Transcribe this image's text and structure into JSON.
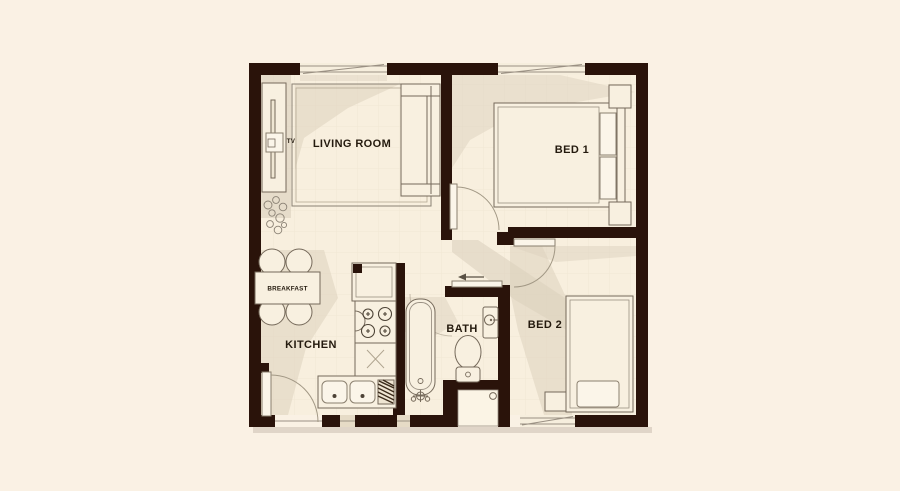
{
  "document": {
    "kind": "apartment floor plan",
    "background_color": "#faf1e4",
    "wall_color": "#2a130a",
    "floor_color": "#f8efde",
    "shadow_color": "#dcd1be"
  },
  "labels": {
    "living_room": "LIVING ROOM",
    "bed_1": "BED 1",
    "bed_2": "BED 2",
    "bath": "BATH",
    "kitchen": "KITCHEN",
    "breakfast": "BREAKFAST",
    "tv": "TV"
  },
  "icons": {
    "sofa": "sofa-icon",
    "rug": "rug-icon",
    "tv_unit": "tv-unit-icon",
    "plant": "plant-icon",
    "breakfast_table": "breakfast-table-icon",
    "fridge": "fridge-icon",
    "stove": "stove-icon",
    "kitchen_sink": "kitchen-sink-icon",
    "bathtub": "bathtub-icon",
    "toilet": "toilet-icon",
    "wash_basin": "wash-basin-icon",
    "double_bed": "double-bed-icon",
    "single_bed": "single-bed-icon",
    "nightstand": "nightstand-icon",
    "entry_arrow": "entry-arrow-icon",
    "door": "door-icon",
    "window": "window-icon"
  }
}
